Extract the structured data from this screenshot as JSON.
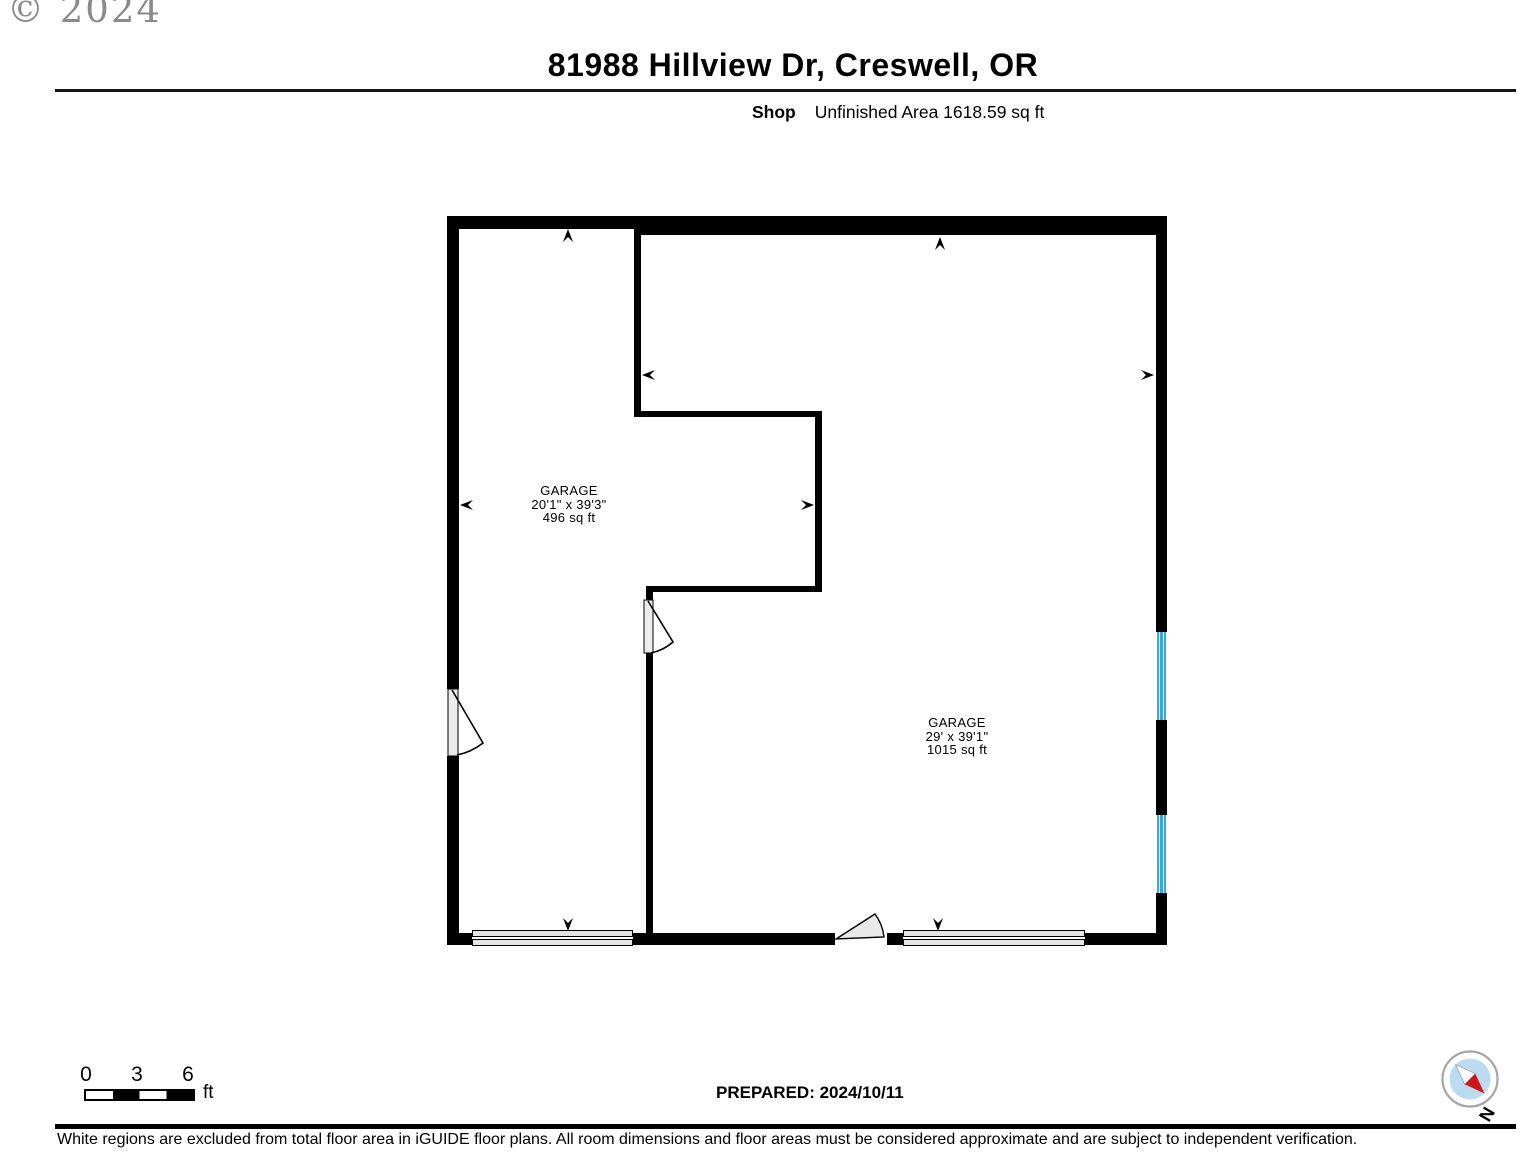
{
  "page": {
    "copyright": "© 2024",
    "title": "81988 Hillview Dr, Creswell, OR",
    "floor_label": "Shop",
    "area_label": "Unfinished Area 1618.59 sq ft",
    "prepared_label": "PREPARED: 2024/10/11",
    "disclaimer": "White regions are excluded from total floor area in iGUIDE floor plans. All room dimensions and floor areas must be considered approximate and are subject to independent verification.",
    "compass_label": "N"
  },
  "scale_bar": {
    "tick_0": "0",
    "tick_1": "3",
    "tick_2": "6",
    "unit": "ft"
  },
  "rooms": [
    {
      "name": "GARAGE",
      "dimensions": "20'1\" x 39'3\"",
      "area": "496 sq ft"
    },
    {
      "name": "GARAGE",
      "dimensions": "29' x 39'1\"",
      "area": "1015 sq ft"
    }
  ],
  "colors": {
    "wall": "#000000",
    "window_blue": "#3fa6da",
    "door_fill": "#ececec",
    "garage_door_fill": "#e4e4e4",
    "compass_inner_blue": "#badcf2",
    "compass_needle_red": "#d01616",
    "copyright_gray": "#8a8a8a"
  }
}
